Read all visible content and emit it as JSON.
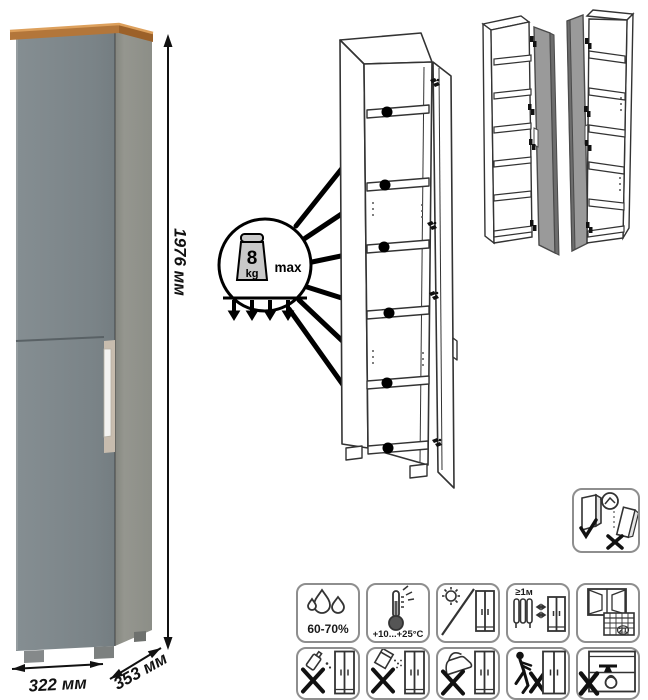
{
  "product": {
    "name": "tall narrow cabinet",
    "dimensions": {
      "height": "1976 мм",
      "width": "322 мм",
      "depth": "353 мм"
    },
    "shelf_load": {
      "value": "8",
      "unit": "kg",
      "qualifier": "max"
    }
  },
  "care": {
    "humidity": "60-70%",
    "temperature": "+10...+25°C",
    "min_distance_from_heat": "≥1м",
    "calendar_day": "21"
  },
  "colors": {
    "door_front": "#7e878b",
    "side_panel": "#90928b",
    "top_trim": "#b3763a",
    "handle": "#f3f3f1",
    "variant_door_gray": "#9a9a9a",
    "line_art": "#333333",
    "icon_border": "#8e8e8e"
  },
  "icons": {
    "anti_tip": "secure-to-wall-anti-tip",
    "row1": [
      "humidity",
      "temperature",
      "no-direct-sunlight",
      "keep-distance-from-heat",
      "ventilate-room"
    ],
    "row2": [
      "no-solvents",
      "no-abrasive-cleaners",
      "no-hot-iron",
      "no-pushing",
      "no-overloading"
    ]
  }
}
